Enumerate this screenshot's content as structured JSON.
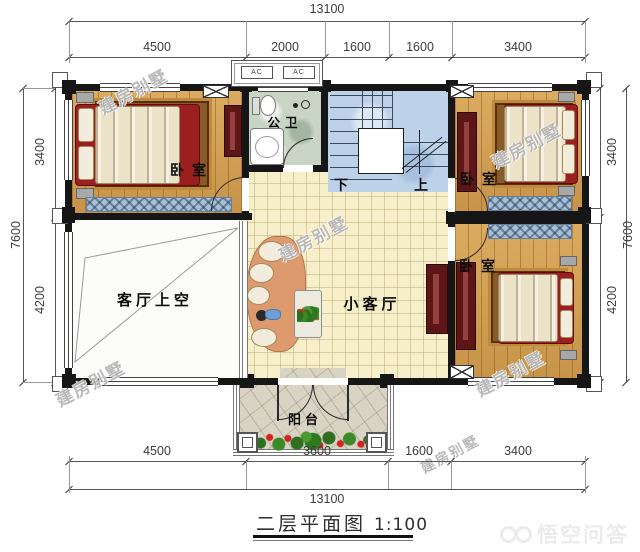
{
  "plan": {
    "caption": "二层平面图",
    "scale": "1:100",
    "watermark": "建房别墅",
    "logo": "悟空问答"
  },
  "dims": {
    "top": {
      "total": "13100",
      "segments": [
        "4500",
        "2000",
        "1600",
        "1600",
        "3400"
      ]
    },
    "bottom": {
      "total": "13100",
      "segments": [
        "4500",
        "3600",
        "1600",
        "3400"
      ]
    },
    "left": {
      "total": "7600",
      "segments": [
        "3400",
        "4200"
      ]
    },
    "right": {
      "total": "7600",
      "segments": [
        "3400",
        "4200"
      ]
    }
  },
  "rooms": {
    "bedroom_top_left": "卧室",
    "bedroom_top_right": "卧室",
    "bedroom_bottom_right": "卧室",
    "bathroom": "公卫",
    "living_void": "客厅上空",
    "small_living": "小客厅",
    "balcony": "阳台",
    "stair_down": "下",
    "stair_up": "上",
    "ac": "AC"
  },
  "colors": {
    "wall": "#161616",
    "wood": "#d2a052",
    "tile": "#f6efca",
    "stair": "#bdd2e9",
    "accent_red": "#9c1f1f"
  }
}
